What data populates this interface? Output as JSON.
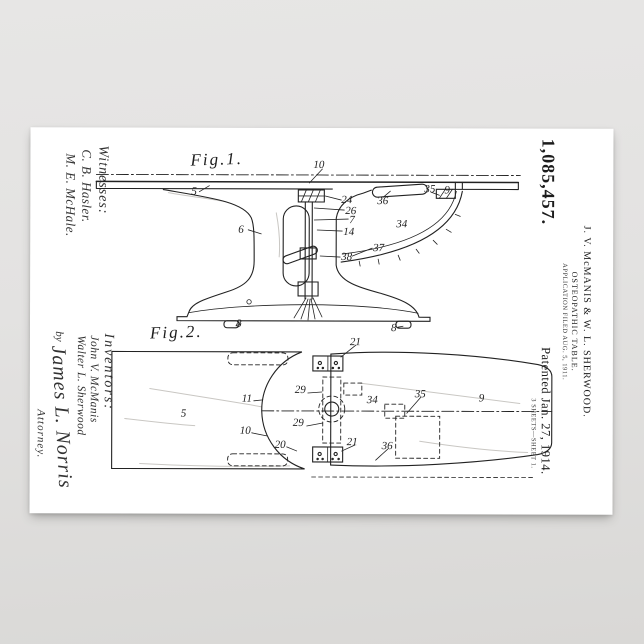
{
  "header": {
    "patent_number": "1,085,457.",
    "name_line": "J. V. McMANIS & W. L. SHERWOOD.",
    "title_line": "OSTEOPATHIC TABLE.",
    "application_line": "APPLICATION FILED AUG. 5, 1911.",
    "patented_line": "Patented Jan. 27, 1914.",
    "sheet_line": "3 SHEETS—SHEET 1."
  },
  "witnesses": {
    "heading": "Witnesses:",
    "signature_1": "C. B. Hasler.",
    "signature_2": "M. E. McHale."
  },
  "inventors": {
    "heading": "Inventors:",
    "name_1": "John V. McManis",
    "name_2": "Walter L. Sherwood",
    "by": "by",
    "attorney_signature": "James L. Norris",
    "attorney_label": "Attorney."
  },
  "figures": {
    "fig1": {
      "title": "Fig.1.",
      "labels": [
        {
          "t": "10",
          "x": 313,
          "y": 161
        },
        {
          "t": "5",
          "x": 191,
          "y": 188
        },
        {
          "t": "6",
          "x": 238,
          "y": 226
        },
        {
          "t": "24",
          "x": 341,
          "y": 196
        },
        {
          "t": "26",
          "x": 345,
          "y": 207
        },
        {
          "t": "7",
          "x": 349,
          "y": 216
        },
        {
          "t": "14",
          "x": 343,
          "y": 228
        },
        {
          "t": "36",
          "x": 377,
          "y": 197
        },
        {
          "t": "35",
          "x": 424,
          "y": 185
        },
        {
          "t": "9",
          "x": 444,
          "y": 186
        },
        {
          "t": "34",
          "x": 396,
          "y": 220
        },
        {
          "t": "37",
          "x": 373,
          "y": 244
        },
        {
          "t": "38",
          "x": 341,
          "y": 253
        },
        {
          "t": "8",
          "x": 236,
          "y": 320
        },
        {
          "t": "8",
          "x": 391,
          "y": 324
        }
      ]
    },
    "fig2": {
      "title": "Fig.2.",
      "labels": [
        {
          "t": "21",
          "x": 350,
          "y": 338
        },
        {
          "t": "29",
          "x": 295,
          "y": 386
        },
        {
          "t": "11",
          "x": 242,
          "y": 395
        },
        {
          "t": "5",
          "x": 181,
          "y": 410
        },
        {
          "t": "29",
          "x": 293,
          "y": 419
        },
        {
          "t": "10",
          "x": 240,
          "y": 427
        },
        {
          "t": "20",
          "x": 275,
          "y": 441
        },
        {
          "t": "34",
          "x": 367,
          "y": 396
        },
        {
          "t": "35",
          "x": 415,
          "y": 390
        },
        {
          "t": "36",
          "x": 382,
          "y": 442
        },
        {
          "t": "21",
          "x": 347,
          "y": 438
        },
        {
          "t": "9",
          "x": 479,
          "y": 394
        }
      ]
    }
  }
}
